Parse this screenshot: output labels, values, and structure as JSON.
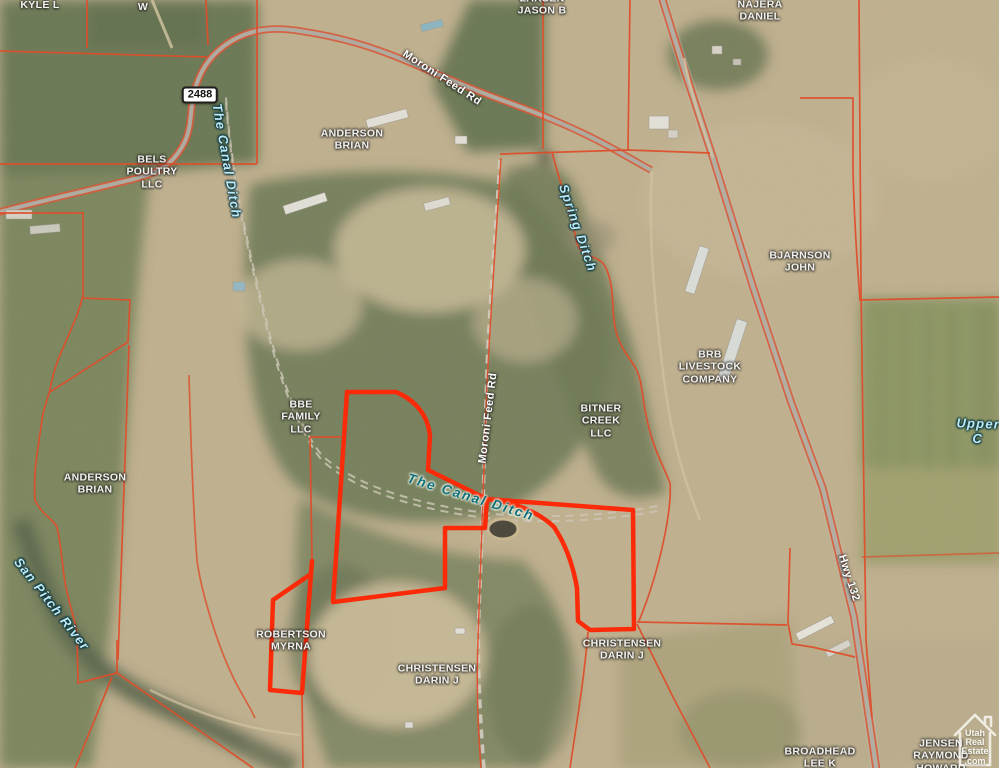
{
  "map": {
    "description": "Aerial parcel map with owner overlays, county road and ditch labels, and a selected listing parcel outlined in bright red",
    "highway_shield": {
      "text": "2488",
      "x": 200,
      "y": 95
    }
  },
  "colors": {
    "parcel_line": "#dd4f2c",
    "selected_parcel": "#fb2a08",
    "road_label": "#ffffff",
    "owner_label": "#f4f2ee",
    "water_label": "#bfe9f5",
    "water_label_dark": "#0f6e7b",
    "shield_background": "#ffffff"
  },
  "labels": [
    {
      "id": "owner-label-kyle-l",
      "cls": "owner",
      "text": "KYLE L",
      "x": 40,
      "y": 5,
      "rot": 0
    },
    {
      "id": "owner-label-w",
      "cls": "owner",
      "text": "W",
      "x": 143,
      "y": 7,
      "rot": 0
    },
    {
      "id": "owner-label-larsen-jason-b",
      "cls": "owner",
      "text": "LARSEN\nJASON B",
      "x": 542,
      "y": 5,
      "rot": 0
    },
    {
      "id": "owner-label-najera-daniel",
      "cls": "owner",
      "text": "NAJERA\nDANIEL",
      "x": 760,
      "y": 11,
      "rot": 0
    },
    {
      "id": "owner-label-bels-poultry-llc",
      "cls": "owner",
      "text": "BELS\nPOULTRY\nLLC",
      "x": 152,
      "y": 172,
      "rot": 0
    },
    {
      "id": "owner-label-anderson-brian-n",
      "cls": "owner",
      "text": "ANDERSON\nBRIAN",
      "x": 352,
      "y": 140,
      "rot": 0
    },
    {
      "id": "owner-label-bjarnson-john",
      "cls": "owner",
      "text": "BJARNSON\nJOHN",
      "x": 800,
      "y": 262,
      "rot": 0
    },
    {
      "id": "owner-label-brb-livestock",
      "cls": "owner",
      "text": "BRB\nLIVESTOCK\nCOMPANY",
      "x": 710,
      "y": 367,
      "rot": 0
    },
    {
      "id": "owner-label-bbe-family-llc",
      "cls": "owner",
      "text": "BBE\nFAMILY\nLLC",
      "x": 301,
      "y": 417,
      "rot": 0
    },
    {
      "id": "owner-label-bitner-creek-llc",
      "cls": "owner",
      "text": "BITNER\nCREEK\nLLC",
      "x": 601,
      "y": 421,
      "rot": 0
    },
    {
      "id": "owner-label-anderson-brian-w",
      "cls": "owner",
      "text": "ANDERSON\nBRIAN",
      "x": 95,
      "y": 484,
      "rot": 0
    },
    {
      "id": "owner-label-robertson-myrna",
      "cls": "owner",
      "text": "ROBERTSON\nMYRNA",
      "x": 291,
      "y": 641,
      "rot": 0
    },
    {
      "id": "owner-label-christensen-c",
      "cls": "owner",
      "text": "CHRISTENSEN\nDARIN J",
      "x": 437,
      "y": 675,
      "rot": 0
    },
    {
      "id": "owner-label-christensen-e",
      "cls": "owner",
      "text": "CHRISTENSEN\nDARIN J",
      "x": 622,
      "y": 650,
      "rot": 0
    },
    {
      "id": "owner-label-broadhead-lee-k",
      "cls": "owner",
      "text": "BROADHEAD\nLEE K",
      "x": 820,
      "y": 758,
      "rot": 0
    },
    {
      "id": "owner-label-jensen-raymond",
      "cls": "owner",
      "text": "JENSEN\nRAYMOND\nHOWARD",
      "x": 941,
      "y": 756,
      "rot": 0
    },
    {
      "id": "road-label-moroni-feed-rd-top",
      "cls": "road",
      "text": "Moroni Feed Rd",
      "x": 442,
      "y": 78,
      "rot": 33
    },
    {
      "id": "road-label-moroni-feed-rd-mid",
      "cls": "road",
      "text": "Moroni Feed Rd",
      "x": 488,
      "y": 418,
      "rot": -83
    },
    {
      "id": "road-label-hwy-132",
      "cls": "road",
      "text": "Hwy 132",
      "x": 849,
      "y": 578,
      "rot": 72
    },
    {
      "id": "ditch-label-canal-top",
      "cls": "ditch",
      "text": "The Canal Ditch",
      "x": 227,
      "y": 161,
      "rot": 80
    },
    {
      "id": "ditch-label-spring",
      "cls": "ditch",
      "text": "Spring Ditch",
      "x": 578,
      "y": 228,
      "rot": 71
    },
    {
      "id": "ditch-label-canal-center",
      "cls": "ditch-dark",
      "text": "The Canal Ditch",
      "x": 471,
      "y": 497,
      "rot": 17
    },
    {
      "id": "river-label-san-pitch",
      "cls": "ditch",
      "text": "San Pitch River",
      "x": 52,
      "y": 604,
      "rot": 52
    },
    {
      "id": "ditch-label-upper",
      "cls": "ditch",
      "text": "Upper C",
      "x": 978,
      "y": 431,
      "rot": 2
    }
  ],
  "shield": {
    "text": "2488"
  },
  "logo": {
    "lines": [
      "Utah",
      "Real",
      "Estate",
      ".com"
    ]
  }
}
